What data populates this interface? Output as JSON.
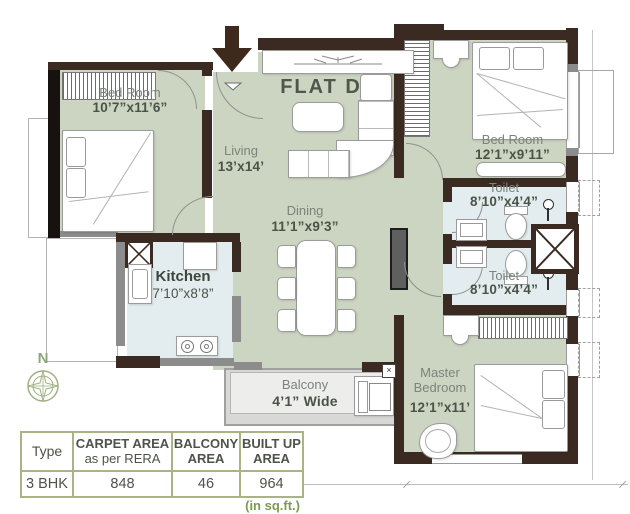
{
  "title": "FLAT D",
  "compass": {
    "label": "N"
  },
  "rooms": {
    "bedroom1": {
      "name": "Bed Room",
      "dims": "10’7”x11’6”"
    },
    "living": {
      "name": "Living",
      "dims": "13’x14’"
    },
    "dining": {
      "name": "Dining",
      "dims": "11’1”x9’3”"
    },
    "bedroom2": {
      "name": "Bed Room",
      "dims": "12’1”x9’11”"
    },
    "toilet1": {
      "name": "Toilet",
      "dims": "8’10”x4’4”"
    },
    "toilet2": {
      "name": "Toilet",
      "dims": "8’10”x4’4”"
    },
    "kitchen": {
      "name": "Kitchen",
      "dims": "7’10”x8’8”"
    },
    "master": {
      "name": "Master",
      "name2": "Bedroom",
      "dims": "12’1”x11’"
    },
    "balcony": {
      "name": "Balcony",
      "dims": "4’1” Wide"
    }
  },
  "area_table": {
    "headers": [
      {
        "line1": "Type",
        "line2": ""
      },
      {
        "line1": "CARPET AREA",
        "line2": "as per RERA"
      },
      {
        "line1": "BALCONY",
        "line2": "AREA"
      },
      {
        "line1": "BUILT UP",
        "line2": "AREA"
      }
    ],
    "row": [
      "3 BHK",
      "848",
      "46",
      "964"
    ],
    "footnote": "(in sq.ft.)"
  },
  "colors": {
    "wall": "#3b2a21",
    "floor_room": "#ccd5c1",
    "floor_wet": "#e3ecee",
    "floor_balcony": "#ededeb",
    "table_border": "#a9b383",
    "footnote_green": "#7d9a52",
    "compass_green": "#9fb17f",
    "label_green": "#7b847b",
    "dim_text": "#4b5348"
  }
}
